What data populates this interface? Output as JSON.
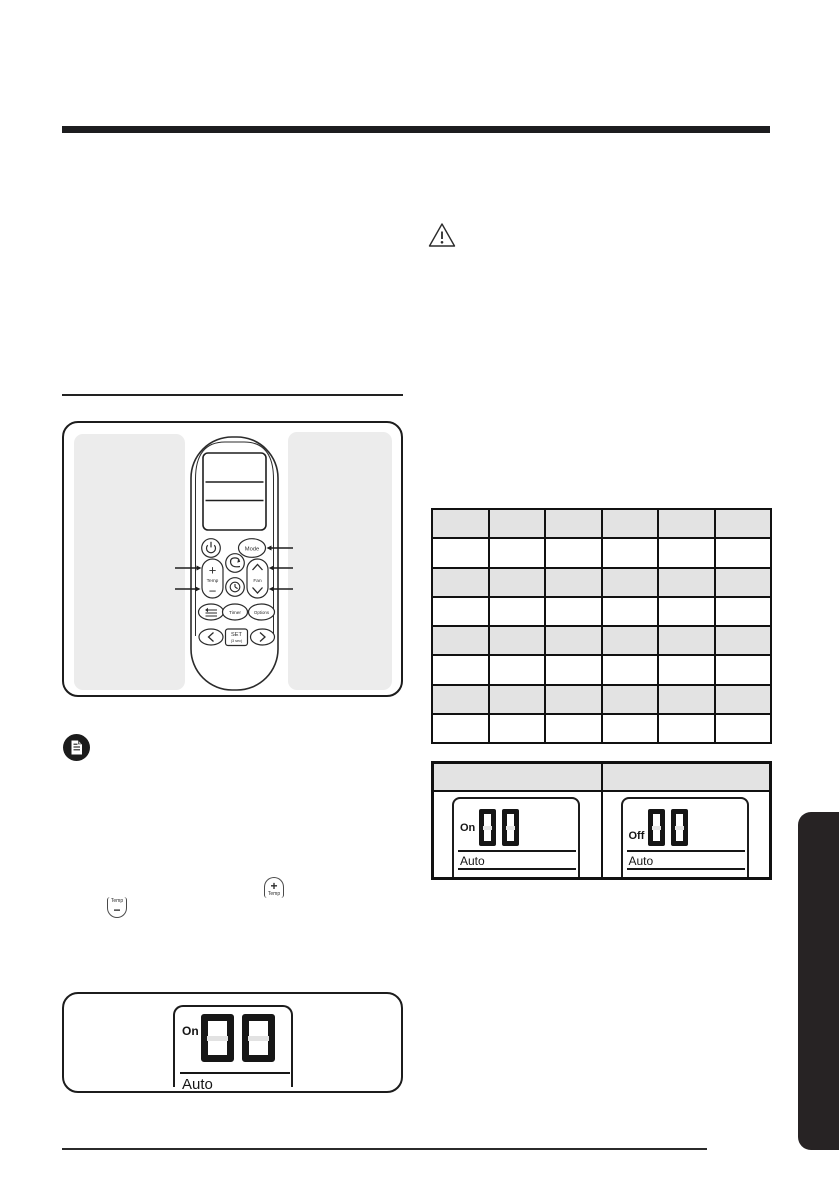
{
  "colors": {
    "ink": "#1c1c1e",
    "panel_gray": "#ececec",
    "table_row_gray": "#e3e3e3",
    "side_tab": "#272324"
  },
  "figure_remote": {
    "buttons": {
      "power": {
        "icon": "power-icon"
      },
      "mode": {
        "label": "Mode"
      },
      "temp": {
        "plus": "+",
        "label": "Temp",
        "minus": "−"
      },
      "air_direction": {
        "icon": "air-direction-icon"
      },
      "clock": {
        "icon": "clock-icon"
      },
      "fan": {
        "label": "Fan",
        "up": "chevron-up-icon",
        "down": "chevron-down-icon"
      },
      "air_swing": {
        "icon": "air-swing-icon"
      },
      "timer": {
        "label": "Timer"
      },
      "options": {
        "label": "Options"
      },
      "set": {
        "label": "SET",
        "sub": "(3 sec)"
      },
      "prev": {
        "icon": "chevron-left-icon"
      },
      "next": {
        "icon": "chevron-right-icon"
      }
    }
  },
  "inline_icons": {
    "temp_up": {
      "sign": "+",
      "label": "Temp"
    },
    "temp_down": {
      "label": "Temp",
      "sign": "−"
    }
  },
  "spec_table": {
    "rows": 8,
    "cols": 6,
    "cells": [
      [
        "",
        "",
        "",
        "",
        "",
        ""
      ],
      [
        "",
        "",
        "",
        "",
        "",
        ""
      ],
      [
        "",
        "",
        "",
        "",
        "",
        ""
      ],
      [
        "",
        "",
        "",
        "",
        "",
        ""
      ],
      [
        "",
        "",
        "",
        "",
        "",
        ""
      ],
      [
        "",
        "",
        "",
        "",
        "",
        ""
      ],
      [
        "",
        "",
        "",
        "",
        "",
        ""
      ],
      [
        "",
        "",
        "",
        "",
        "",
        ""
      ]
    ]
  },
  "timer_table": {
    "headers": [
      "",
      ""
    ],
    "cells": [
      {
        "status": "On",
        "value": "00",
        "mode": "Auto"
      },
      {
        "status": "Off",
        "value": "00",
        "mode": "Auto"
      }
    ]
  },
  "bottom_figure": {
    "status": "On",
    "value": "00",
    "mode": "Auto"
  }
}
